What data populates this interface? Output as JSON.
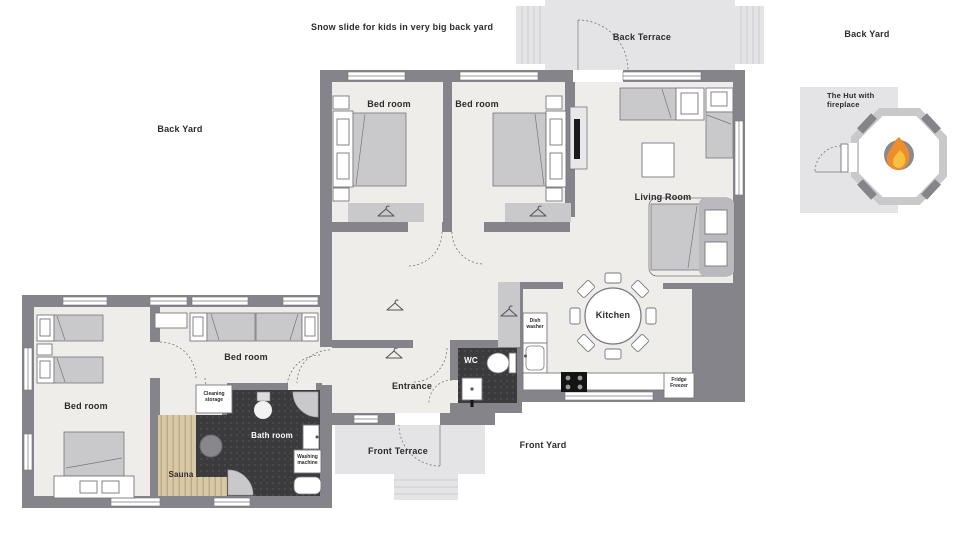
{
  "labels": {
    "snow_slide": "Snow slide for kids in very big back yard",
    "back_terrace": "Back Terrace",
    "back_yard_right": "Back Yard",
    "back_yard_left": "Back Yard",
    "front_terrace": "Front Terrace",
    "front_yard": "Front Yard",
    "hut": "The Hut with fireplace"
  },
  "rooms": {
    "bedroom_a": "Bed room",
    "bedroom_b": "Bed room",
    "living_room": "Living Room",
    "kitchen": "Kitchen",
    "entrance": "Entrance",
    "wc": "WC",
    "bedroom_c": "Bed room",
    "bedroom_d": "Bed room",
    "sauna": "Sauna",
    "bath_room": "Bath room"
  },
  "fixtures": {
    "dish_washer": "Dish washer",
    "fridge_freezer": "Fridge Freezer",
    "cleaning_storage": "Cleaning storage",
    "washing_machine": "Washing machine"
  },
  "palette": {
    "wall": "#84848a",
    "floor": "#efedea",
    "terrace": "#e4e4e6",
    "furniture": "#c9c9cc",
    "furniture_dark": "#b9b9be",
    "outline": "#77777c",
    "dark_floor": "#3b3b3e",
    "wood": "#d9c8a6",
    "wood_line": "#b7a47c",
    "flame_orange": "#ee8d2b",
    "flame_yellow": "#f6c041"
  }
}
